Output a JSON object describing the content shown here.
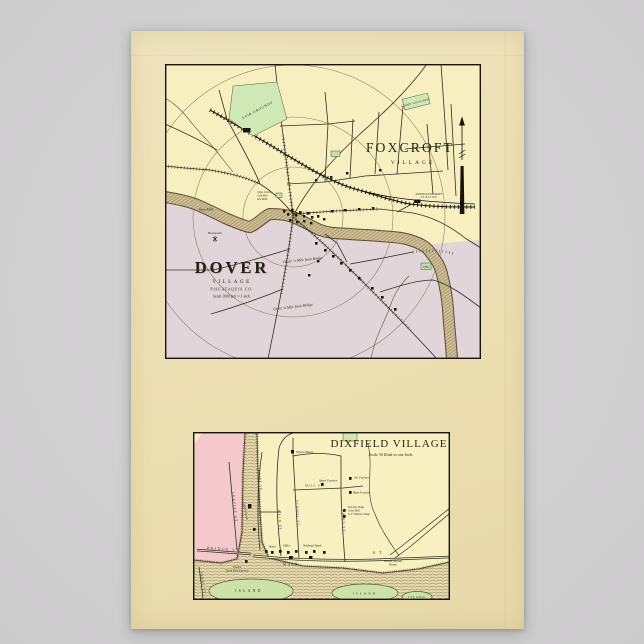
{
  "scene": {
    "background_color": "#d2d2d3",
    "paper_color": "#ecdfb3",
    "ink_color": "#2c261d",
    "foxcroft_fill": "#f7efbf",
    "dover_fill": "#e1d5d9",
    "dixfield_pink": "#f3c9cb",
    "grounds_green": "#cfe8b6",
    "island_green": "#cde2a6",
    "river_tan": "#d9caa0"
  },
  "top_map": {
    "foxcroft_title": "FOXCROFT",
    "foxcroft_subtitle": "VILLAGE",
    "dover_title": "DOVER",
    "dover_subtitle": "VILLAGE",
    "dover_county": "PISCATAQUIS CO.",
    "dover_scale": "Scale 1600 feet = 1 inch.",
    "fair_grounds": "FAIR GROUNDS",
    "camp_grounds": "CAMP GROUNDS",
    "station_line1": "DOVER & FOXCROFT",
    "station_line2": "STATION",
    "river_label": "Pine Alley",
    "hamlet_label": "Bowerania",
    "circle_inner": "Circle ½ Mile from Bridge",
    "circle_outer": "Circle ¾ Mile from Bridge",
    "mill_label1": "Cong. Church",
    "mill_label2": "Grist Mill",
    "mill_label3": "Saw Mills",
    "cem_label": "CEM."
  },
  "bottom_map": {
    "title": "DIXFIELD VILLAGE",
    "scale": "Scale 30 Rods to one Inch.",
    "streets": {
      "main": "MAIN",
      "main_st": "S T.",
      "bridge": "BRIDGE ST.",
      "leavitt": "LEAVITT ST.",
      "ferry": "FERRY ST.",
      "weld": "WELD ST.",
      "cliff": "CLIFF ST.",
      "school": "SCHOOL ST.",
      "third": "THIRD ST.",
      "mill": "MILL ST."
    },
    "places": {
      "school_house": "School House",
      "union_church": "Union Church",
      "spool_factory": "Spool Factory",
      "tin_factory": "Tin Factory",
      "rake_factory": "Rake Factory",
      "novelty_shop": "Novelty Shop",
      "grist_mill": "Grist Mill",
      "woolen_shop": "S. F. Woolen Shop",
      "national_bank": "National Bank",
      "office": "Office",
      "hotel": "Hotel",
      "trask1": "Trask's",
      "trask2": "Tooth Pick Factory",
      "wilson1": "Wilson Keyson",
      "wilson2": "House",
      "island1": "ISLAND",
      "island2": "ISLAND",
      "island3": "ISLAND"
    }
  }
}
